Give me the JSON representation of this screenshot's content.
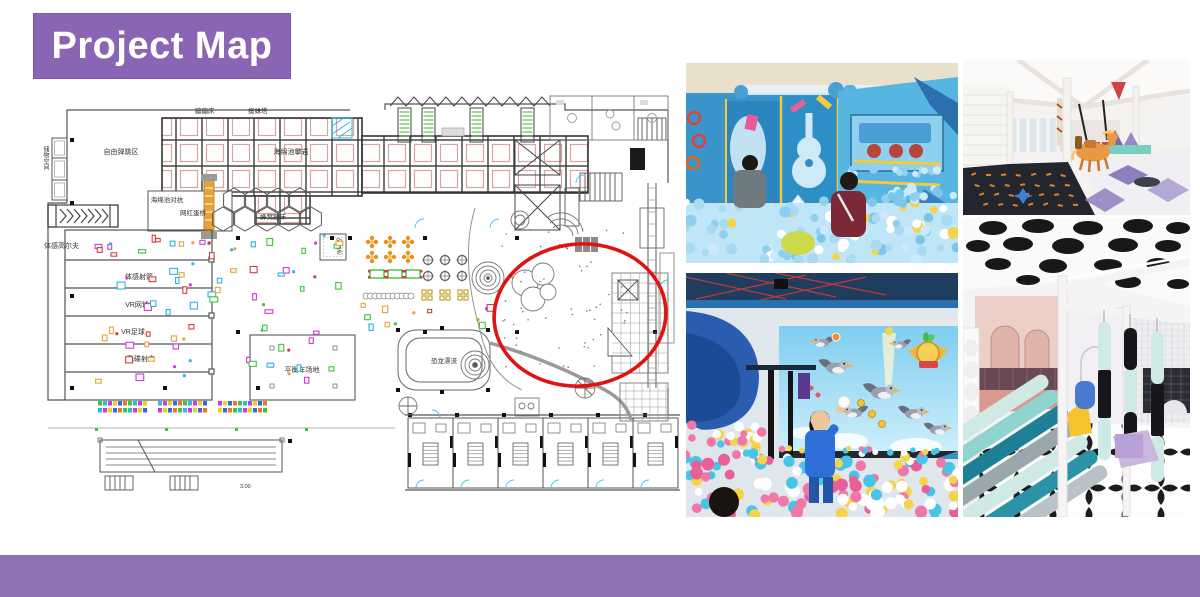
{
  "slide": {
    "title": "Project Map",
    "colors": {
      "header_purple": "#8a65b4",
      "footer_purple": "#8e72b4",
      "annotation_red": "#e01212"
    }
  },
  "floor_plan": {
    "name": "indoor-playground-floor-plan",
    "labels": {
      "top_label_1": "蹦蹦床",
      "top_label_2": "蜘蛛塔",
      "free_jump_zone": "自由弹跳区",
      "sponge_pool_climb": "海绵池攀岩",
      "sponge_pool_battle": "海绵池对抗",
      "egg_bridge": "网红蛋桥",
      "honeycomb_trampoline": "蜂窝蹦床",
      "storage": "储物空间",
      "fishing_pool": "钓鱼池",
      "motion_golf": "体感高尔夫",
      "motion_archery": "体感射箭",
      "vr_tennis": "VR网球",
      "vr_soccer": "VR足球",
      "disc_shooting": "飞碟射击",
      "balance_bike_field": "平衡车场地",
      "dinosaur_drift": "恐龙漂流",
      "dimension": "3.00"
    },
    "annotation": {
      "shape": "red-ellipse",
      "meaning": "highlighted themed play zone"
    }
  },
  "photos": [
    {
      "id": "ball-pit-interactive-wall",
      "description": "blue ball pit with interactive guitar wall"
    },
    {
      "id": "horse-swing-room",
      "description": "white frame room with horse swing and net floor"
    },
    {
      "id": "projection-ball-game",
      "description": "child throwing balls at projection game screen"
    },
    {
      "id": "black-white-playroom",
      "description": "monochrome playroom with roller steps and punch bags"
    }
  ]
}
